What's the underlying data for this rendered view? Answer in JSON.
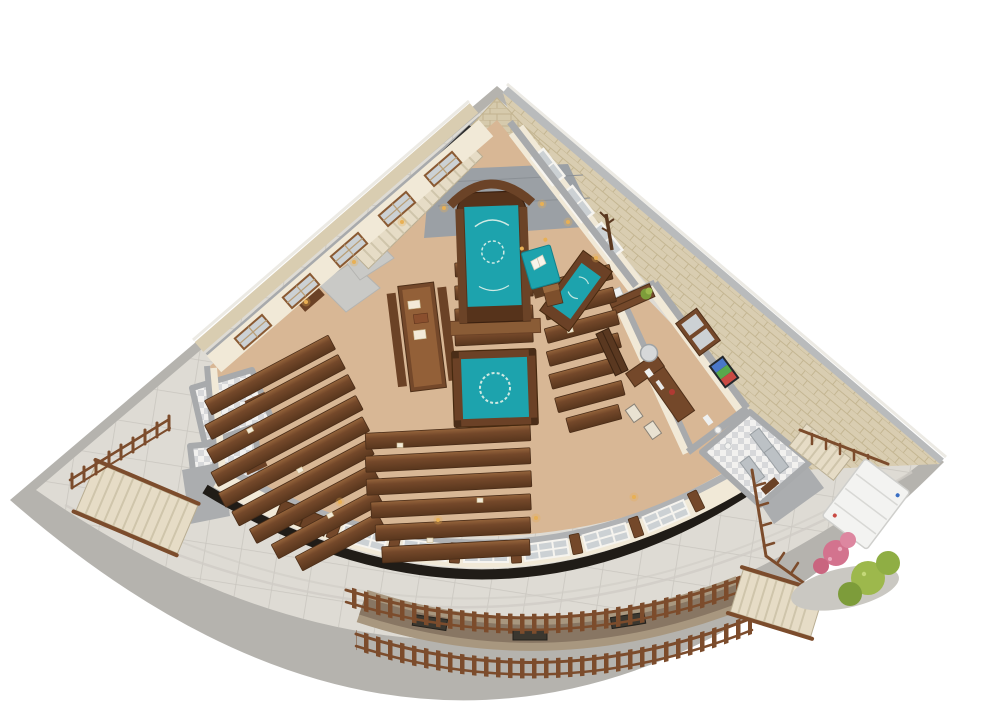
{
  "render": {
    "subject": "Isometric 3D cutaway floor plan of a synagogue with surrounding stone plaza",
    "view": "top-down isometric architectural rendering"
  },
  "colors": {
    "background": "#ffffff",
    "rim": "#b5b3ae",
    "plaza": "#dedbd4",
    "plazaLine": "#c9c6bf",
    "wallStone": "#d9cdb1",
    "wallCap": "#a8aaac",
    "innerWall": "#f1e9d7",
    "carpet": "#d8b795",
    "wood": "#74482a",
    "woodDark": "#5a3820",
    "pew": "#6f4628",
    "teal": "#1da3ad",
    "steps": "#e6dcc6",
    "ironRailing": "#2e2e2e",
    "fence": "#7c4c2c",
    "glass": "#ccd1d4",
    "tile": "#f2f1ef",
    "stall": "#bcc1c5",
    "shadowBand": "#201c17",
    "lift": "#f3f3f1",
    "shrubGreen": "#9db84c",
    "flowerPink": "#d3738e",
    "lamp": "#e8b054",
    "platformGray": "#9ba0a5"
  },
  "areas": {
    "sanctuary": {
      "name": "main sanctuary",
      "furniture": [
        "torah-ark",
        "teal-parochet-curtain",
        "reader-lectern",
        "torah-reading-cabinet",
        "bimah-with-teal-cover",
        "pew-rows",
        "study-table-with-benches",
        "shtender",
        "coat-rack",
        "wall-sconces"
      ]
    },
    "office": {
      "name": "office",
      "furniture": [
        "desk",
        "office-chair",
        "guest-chairs",
        "bookshelf",
        "printer",
        "plant",
        "window",
        "wall-tv"
      ]
    },
    "restroom": {
      "name": "restroom with stalls",
      "furniture": [
        "toilet-stalls",
        "fixtures",
        "checkered-tile-floor"
      ]
    },
    "side_rooms": {
      "name": "tiled washrooms",
      "furniture": [
        "tile-floors",
        "doors"
      ]
    },
    "mezzanine_stairs": {
      "name": "interior staircase with black iron railing"
    },
    "exterior": {
      "name": "stone plaza",
      "features": [
        "outdoor-stairs-left",
        "outdoor-stairs-right",
        "picket-fenced-light-well",
        "basement-windows",
        "platform-lift",
        "flower-shrubs",
        "wooden-fences",
        "entry-landing"
      ]
    }
  }
}
